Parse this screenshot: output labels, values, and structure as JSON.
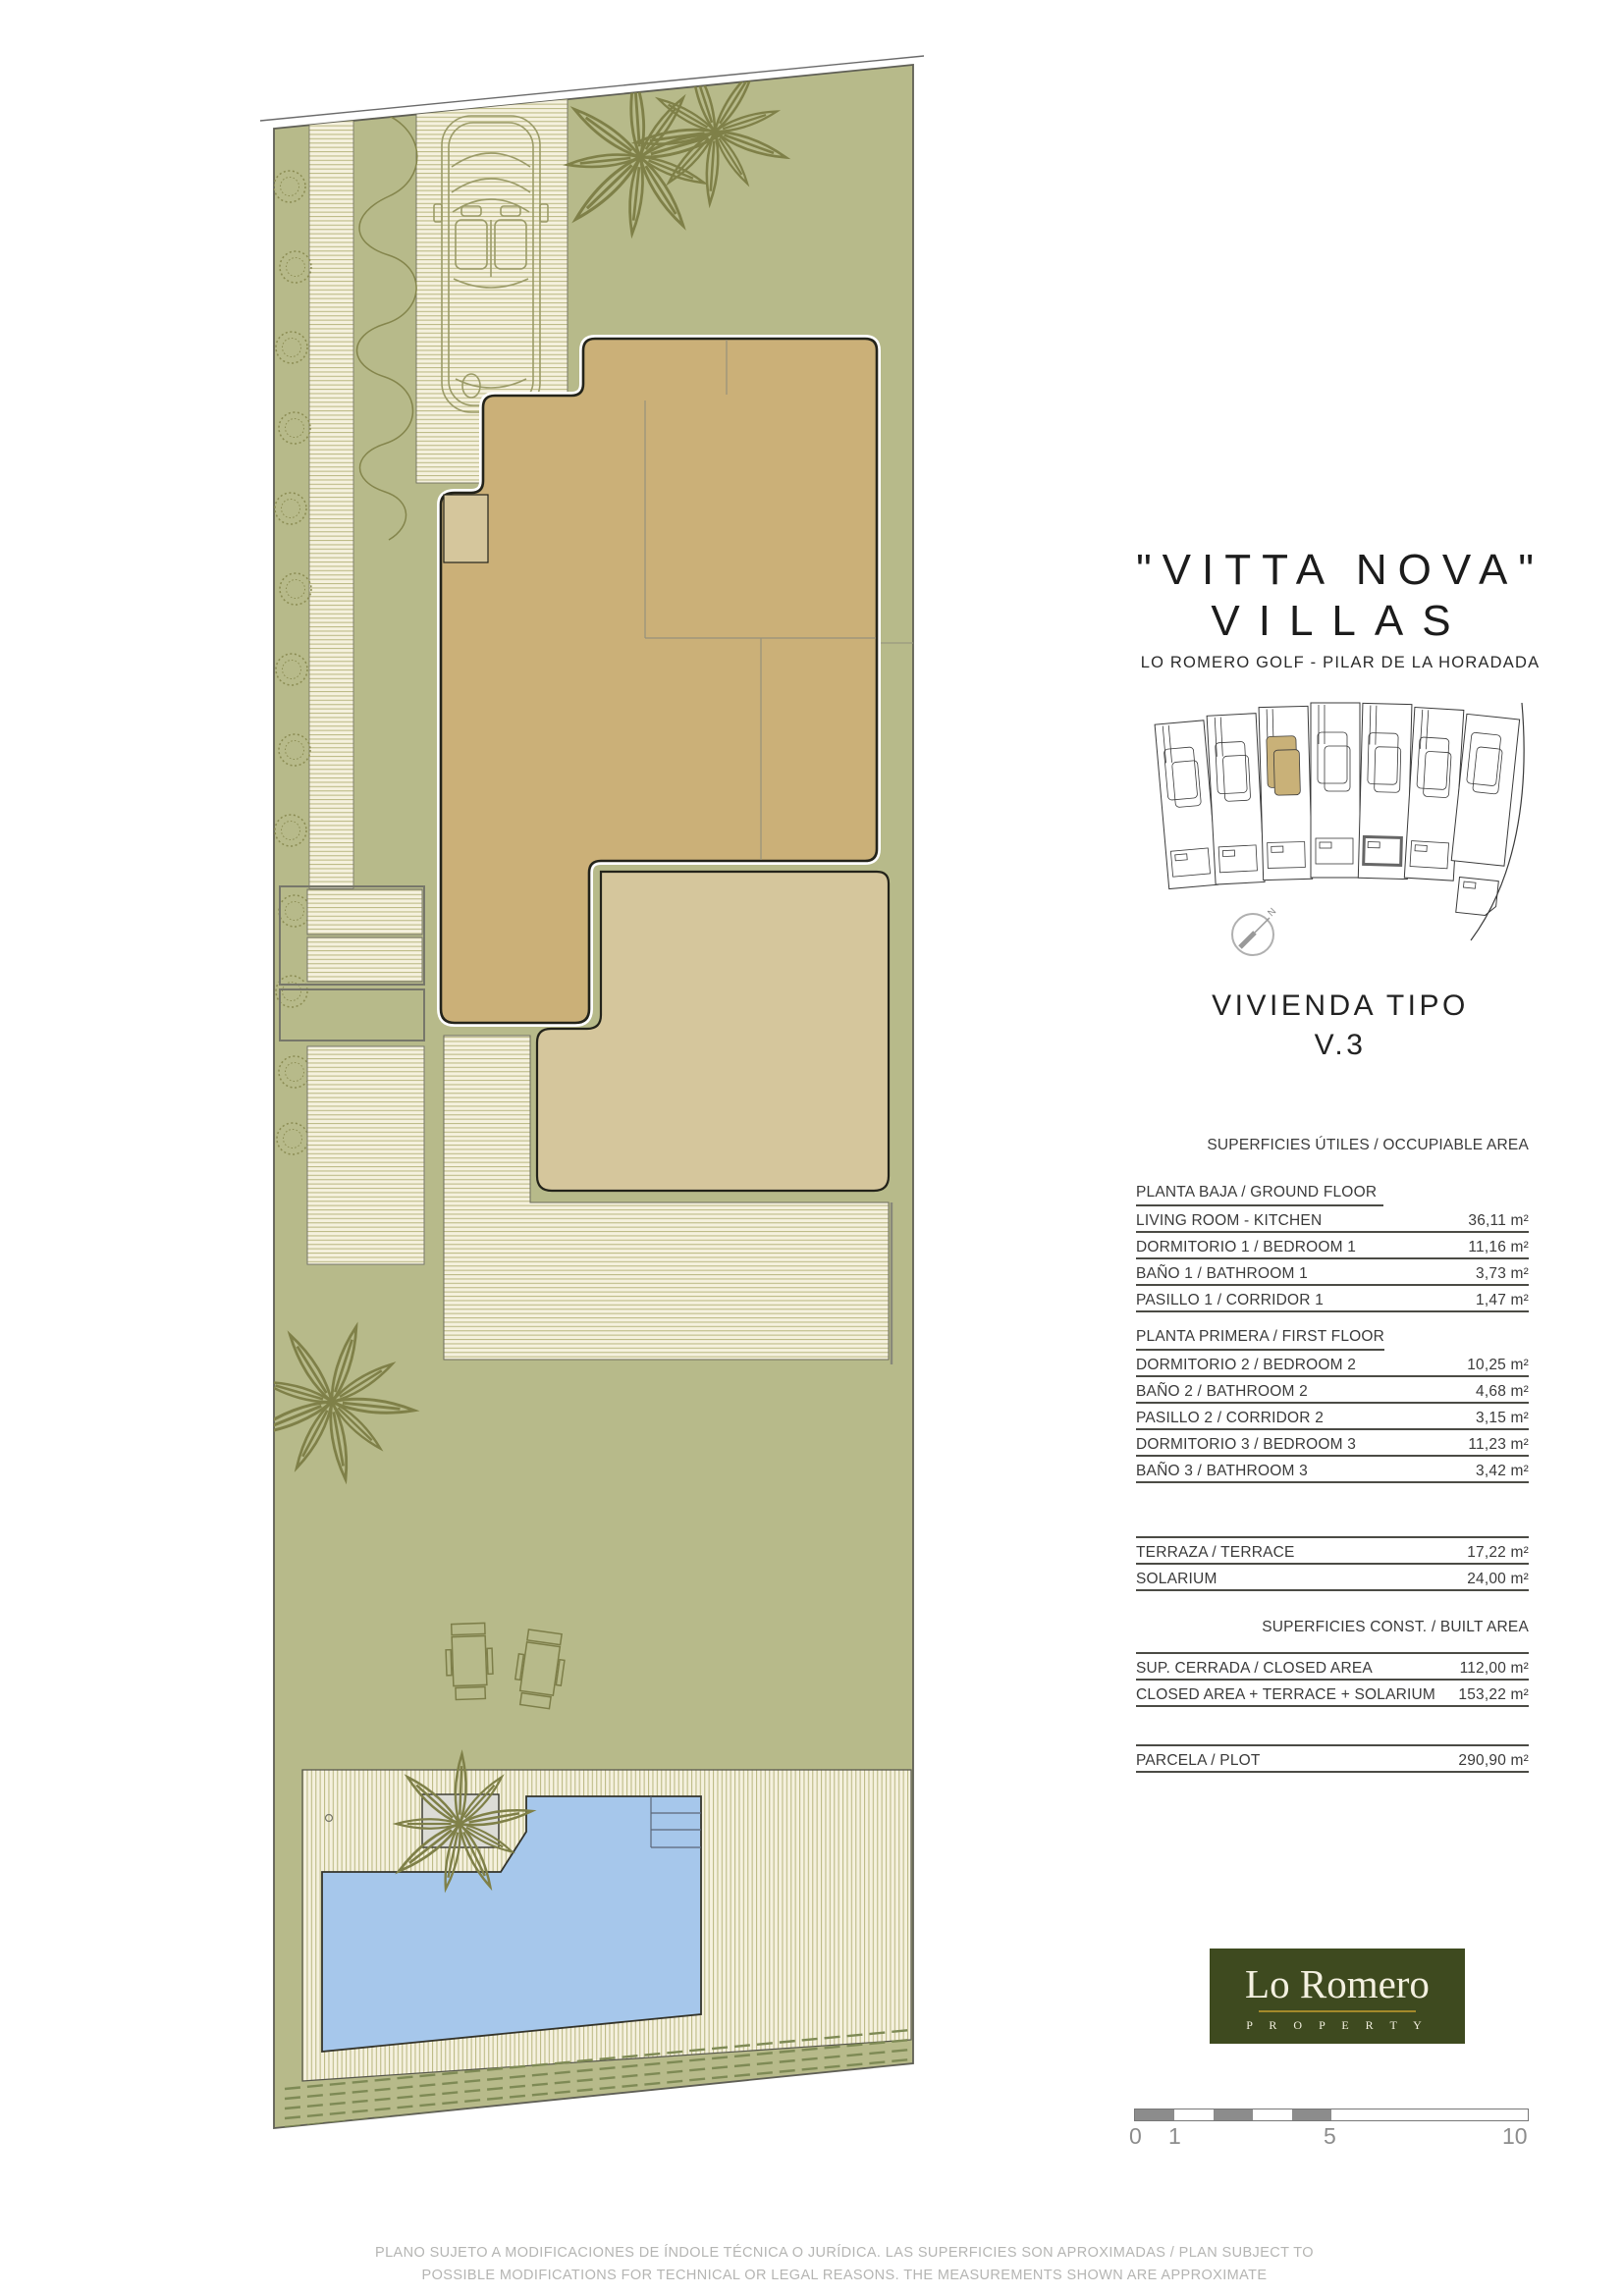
{
  "title": {
    "line1": "\"VITTA NOVA\"",
    "line2": "VILLAS",
    "subtitle": "LO ROMERO GOLF  -  PILAR DE LA HORADADA"
  },
  "type_label": {
    "line1": "VIVIENDA TIPO",
    "line2": "V.3"
  },
  "tables": {
    "occupiable_header": "SUPERFICIES ÚTILES / OCCUPIABLE AREA",
    "ground": {
      "section": "PLANTA BAJA / GROUND FLOOR",
      "rows": [
        {
          "label": "LIVING ROOM - KITCHEN",
          "value": "36,11 m²"
        },
        {
          "label": "DORMITORIO 1 /  BEDROOM 1",
          "value": "11,16 m²"
        },
        {
          "label": "BAÑO 1 / BATHROOM 1",
          "value": "3,73 m²"
        },
        {
          "label": "PASILLO 1 / CORRIDOR 1",
          "value": "1,47 m²"
        }
      ]
    },
    "first": {
      "section": "PLANTA PRIMERA / FIRST FLOOR",
      "rows": [
        {
          "label": "DORMITORIO 2 / BEDROOM 2",
          "value": "10,25 m²"
        },
        {
          "label": "BAÑO 2 / BATHROOM 2",
          "value": "4,68 m²"
        },
        {
          "label": "PASILLO 2 / CORRIDOR 2",
          "value": "3,15 m²"
        },
        {
          "label": "DORMITORIO 3 / BEDROOM 3",
          "value": "11,23 m²"
        },
        {
          "label": "BAÑO 3 / BATHROOM 3",
          "value": "3,42 m²"
        }
      ]
    },
    "outdoor": {
      "rows": [
        {
          "label": "TERRAZA / TERRACE",
          "value": "17,22 m²"
        },
        {
          "label": "SOLARIUM",
          "value": "24,00 m²"
        }
      ]
    },
    "built_header": "SUPERFICIES  CONST. / BUILT AREA",
    "built": {
      "rows": [
        {
          "label": "SUP. CERRADA / CLOSED AREA",
          "value": "112,00 m²"
        },
        {
          "label": "CLOSED AREA + TERRACE + SOLARIUM",
          "value": "153,22 m²"
        }
      ]
    },
    "plot": {
      "rows": [
        {
          "label": "PARCELA / PLOT",
          "value": "290,90 m²"
        }
      ]
    }
  },
  "keyplan": {
    "plots_total": 7,
    "highlighted_plot": 3,
    "north_label": "N"
  },
  "logo": {
    "name": "Lo Romero",
    "tagline": "P R O P E R T Y"
  },
  "scalebar": {
    "labels": [
      "0",
      "1",
      "5",
      "10"
    ]
  },
  "disclaimer": {
    "line1": "PLANO SUJETO A MODIFICACIONES DE ÍNDOLE TÉCNICA O JURÍDICA. LAS SUPERFICIES SON APROXIMADAS / PLAN SUBJECT TO",
    "line2": "POSSIBLE MODIFICATIONS FOR TECHNICAL OR LEGAL REASONS. THE MEASUREMENTS SHOWN ARE APPROXIMATE"
  },
  "colors": {
    "garden_green": "#b7ba8a",
    "building_tan": "#cbb078",
    "terrace_tan": "#d5c69c",
    "pool_blue": "#a6c7eb",
    "logo_green": "#3e4a1f",
    "logo_gold": "#a3892a",
    "scale_gray": "#8c8c8c"
  }
}
